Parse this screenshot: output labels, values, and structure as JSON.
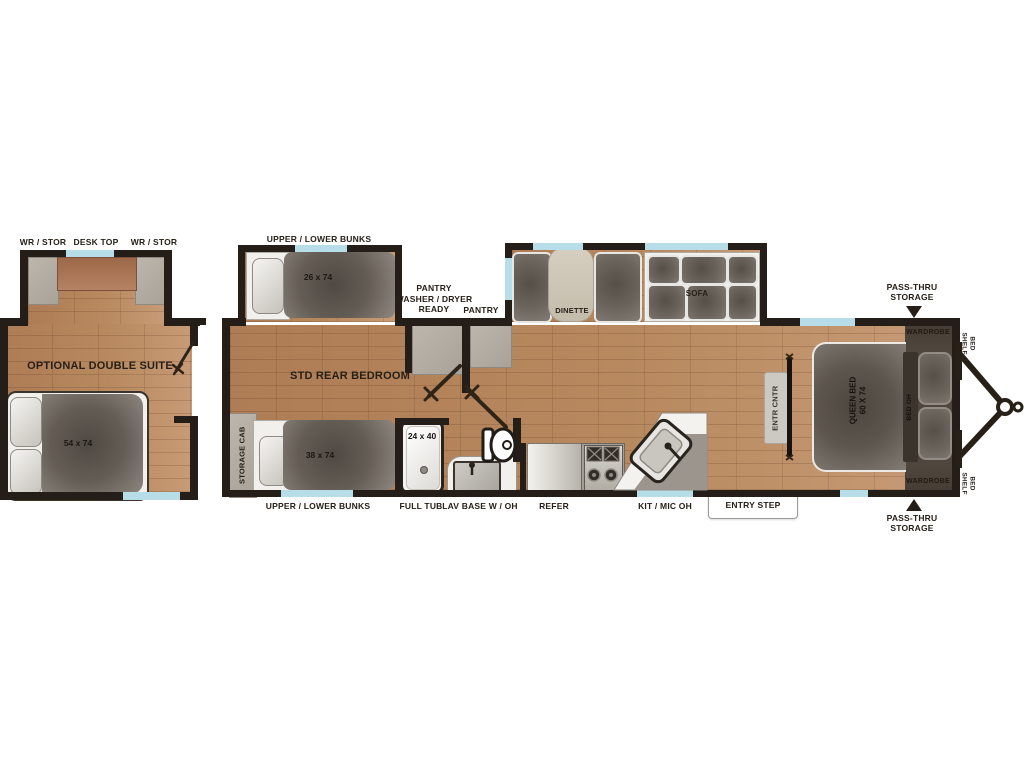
{
  "title": "Travel trailer floorplan",
  "colors": {
    "wall": "#241d18",
    "floor_wood": "#b8895f",
    "window": "#b7dde8",
    "furniture_dark": "#645d55"
  },
  "left": {
    "top_labels": [
      "WR / STOR",
      "DESK TOP",
      "WR / STOR"
    ],
    "room": "OPTIONAL DOUBLE SUITE",
    "bed_size": "54 x 74"
  },
  "main": {
    "bunk_slide_label": "UPPER / LOWER BUNKS",
    "bunk_slide_size": "26 x 74",
    "bedroom": "STD REAR BEDROOM",
    "pantry_block": "PANTRY\nWASHER / DRYER\nREADY",
    "pantry": "PANTRY",
    "dinette": "DINETTE",
    "sofa": "SOFA",
    "storage_cab": "STORAGE CAB",
    "bottom_bunk_label": "UPPER / LOWER BUNKS",
    "bottom_bunk_size": "38 x 74",
    "tub_size": "24 x 40",
    "full_tub": "FULL TUB",
    "lav": "LAV BASE W / OH",
    "refer": "REFER",
    "kit": "KIT / MIC OH",
    "entry_step": "ENTRY STEP",
    "entr_cntr": "ENTR CNTR",
    "queen_bed": "QUEEN BED\n60 X 74",
    "bed_oh": "BED OH",
    "wardrobe_top": "WARDROBE",
    "wardrobe_bottom": "WARDROBE",
    "bed_shelf_top": "BED\nSHELF",
    "bed_shelf_bottom": "BED\nSHELF",
    "pass_thru_top": "PASS-THRU\nSTORAGE",
    "pass_thru_bottom": "PASS-THRU\nSTORAGE"
  }
}
